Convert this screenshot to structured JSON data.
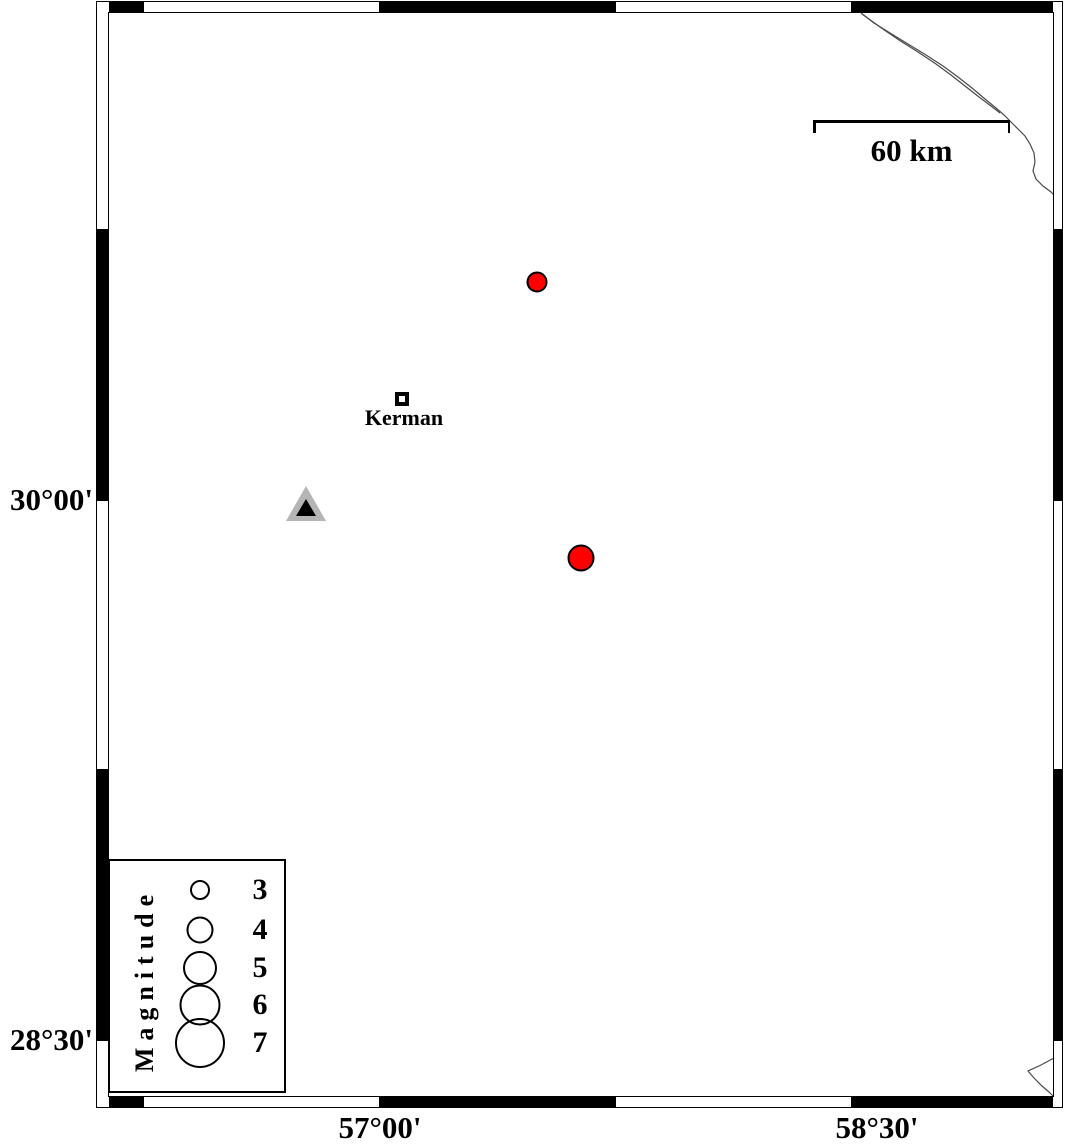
{
  "map_figure": {
    "canvas": {
      "width": 1066,
      "height": 1144,
      "background": "#ffffff"
    },
    "colors": {
      "frame_fill": "#000000",
      "earthquake_fill": "#ff0000",
      "station_outer": "#b5b5b5",
      "station_inner": "#000000",
      "boundary_line": "#4a4a4a"
    },
    "frame": {
      "outer": {
        "x": 96,
        "y": 1,
        "w": 967,
        "h": 1107
      },
      "inner": {
        "x": 108,
        "y": 12,
        "w": 946,
        "h": 1085
      },
      "bands": {
        "top": {
          "y": 2,
          "h": 11
        },
        "bottom": {
          "y": 1096,
          "h": 11
        },
        "left": {
          "x": 97,
          "w": 12
        },
        "right": {
          "x": 1053,
          "w": 10
        }
      },
      "x_black": [
        [
          109,
          143
        ],
        [
          380,
          615
        ],
        [
          852,
          1053
        ]
      ],
      "y_black": [
        [
          230,
          500
        ],
        [
          770,
          1040
        ]
      ],
      "x_ticks": [
        143,
        380,
        615,
        852
      ],
      "y_ticks": [
        230,
        500,
        770,
        1040
      ]
    },
    "axes": {
      "left": [
        {
          "label": "30°00'",
          "y": 500
        },
        {
          "label": "28°30'",
          "y": 1040
        }
      ],
      "bottom": [
        {
          "label": "57°00'",
          "x": 380
        },
        {
          "label": "58°30'",
          "x": 877
        }
      ]
    },
    "scale_bar": {
      "label": "60 km",
      "x1": 813,
      "x2": 1010,
      "y": 120
    },
    "city": {
      "label": "Kerman",
      "x": 402,
      "y": 399,
      "label_y": 405
    },
    "station": {
      "outer_points": "306,486 286,521 326,521",
      "inner_points": "306,499 296,516 316,516"
    },
    "earthquakes": [
      {
        "x": 537,
        "y": 282,
        "d": 21
      },
      {
        "x": 581,
        "y": 558,
        "d": 27
      }
    ],
    "legend": {
      "title": "Magnitude",
      "box": {
        "x": 108,
        "y": 859,
        "w": 178,
        "h": 234
      },
      "title_cx": 143,
      "title_cy": 978,
      "circle_cx": 198,
      "value_cx": 258,
      "entries": [
        {
          "value": "3",
          "d": 20,
          "y": 888
        },
        {
          "value": "4",
          "d": 27,
          "y": 928
        },
        {
          "value": "5",
          "d": 34,
          "y": 966
        },
        {
          "value": "6",
          "d": 41,
          "y": 1003
        },
        {
          "value": "7",
          "d": 50,
          "y": 1041
        }
      ]
    },
    "boundary_lines": [
      {
        "points": [
          [
            861,
            13
          ],
          [
            874,
            23
          ],
          [
            890,
            33
          ],
          [
            908,
            44
          ],
          [
            926,
            55
          ],
          [
            943,
            66
          ],
          [
            958,
            77
          ],
          [
            972,
            88
          ],
          [
            985,
            99
          ],
          [
            996,
            108
          ],
          [
            1004,
            115
          ],
          [
            1011,
            122
          ],
          [
            1018,
            129
          ],
          [
            1025,
            136
          ],
          [
            1030,
            144
          ],
          [
            1034,
            153
          ],
          [
            1035,
            162
          ],
          [
            1033,
            171
          ],
          [
            1036,
            179
          ],
          [
            1043,
            186
          ],
          [
            1051,
            192
          ],
          [
            1054,
            195
          ]
        ]
      },
      {
        "points": [
          [
            862,
            14
          ],
          [
            880,
            27
          ],
          [
            899,
            40
          ],
          [
            918,
            52
          ],
          [
            936,
            64
          ],
          [
            951,
            75
          ],
          [
            965,
            86
          ],
          [
            979,
            97
          ],
          [
            991,
            106
          ],
          [
            1000,
            113
          ]
        ]
      },
      {
        "points": [
          [
            1054,
            1058
          ],
          [
            1041,
            1065
          ],
          [
            1028,
            1071
          ],
          [
            1034,
            1078
          ],
          [
            1042,
            1086
          ],
          [
            1049,
            1092
          ],
          [
            1053,
            1096
          ]
        ]
      }
    ]
  }
}
